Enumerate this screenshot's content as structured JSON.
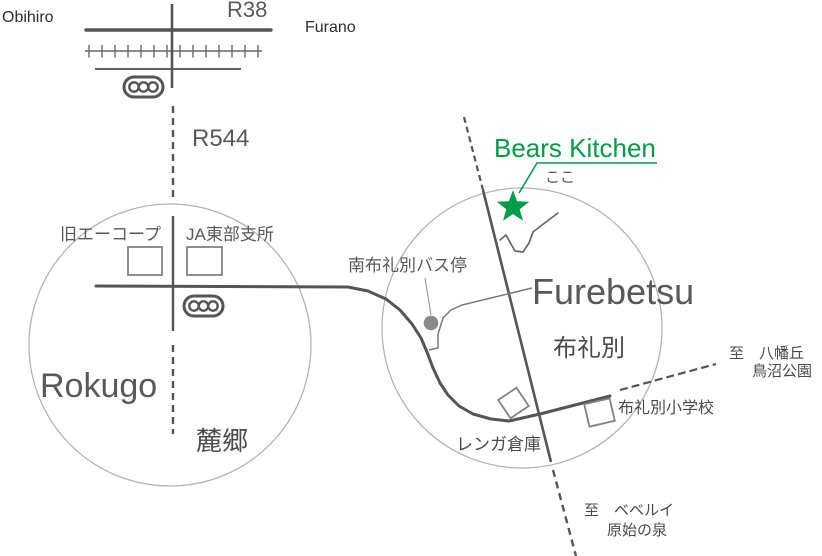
{
  "map_title": "Bears Kitchen access map",
  "colors": {
    "road_dark": "#555555",
    "road_thin": "#7a7a7a",
    "railway": "#666666",
    "area_circle": "#b4b4b4",
    "building_outline": "#828282",
    "bus_dot": "#8a8a8a",
    "accent_green": "#009c47",
    "text_dark": "#2e2e2e",
    "text_gray": "#595959"
  },
  "labels": {
    "obihiro": "Obihiro",
    "furano": "Furano",
    "route38": "R38",
    "route544": "R544",
    "bears_kitchen": "Bears Kitchen",
    "here": "ここ",
    "furebetsu_en": "Furebetsu",
    "furebetsu_jp": "布礼別",
    "rokugo_en": "Rokugo",
    "rokugo_jp": "麓郷",
    "old_acoop": "旧エーコープ",
    "ja_tobu_branch": "JA東部支所",
    "bus_stop": "南布礼別バス停",
    "brick_warehouse": "レンガ倉庫",
    "elementary_school": "布礼別小学校",
    "to_hachimangaoka": "至　八幡丘",
    "torinuma_park": "鳥沼公園",
    "to_beberui": "至　ベベルイ",
    "primeval_spring": "原始の泉"
  }
}
